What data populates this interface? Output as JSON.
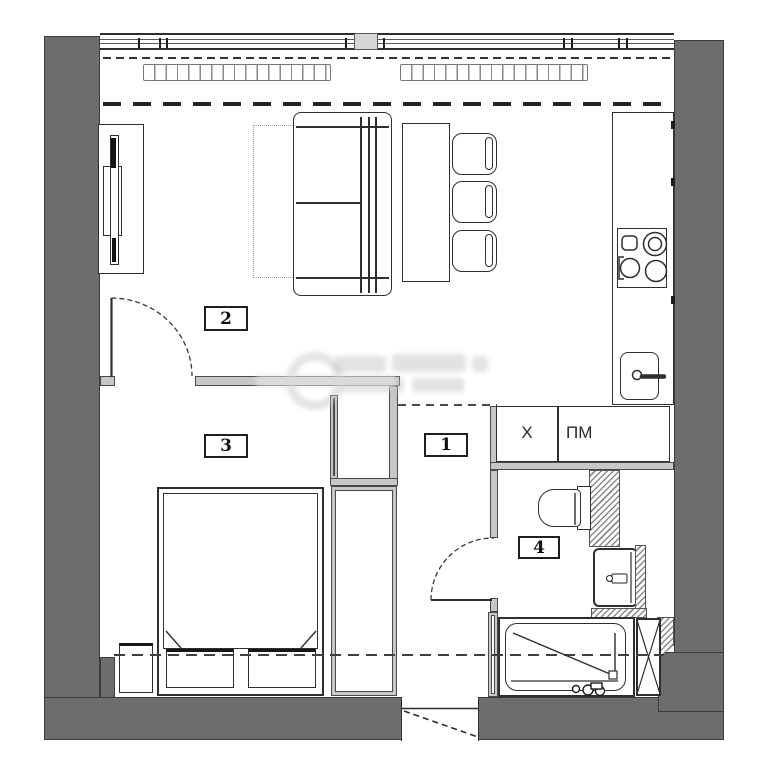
{
  "plan": {
    "type": "apartment-floor-plan",
    "rooms": [
      {
        "key": "living-room",
        "label": "2"
      },
      {
        "key": "bedroom",
        "label": "3"
      },
      {
        "key": "hallway",
        "label": "1"
      },
      {
        "key": "bathroom",
        "label": "4"
      }
    ],
    "appliances": [
      {
        "key": "fridge",
        "label": "Х"
      },
      {
        "key": "dishwasher",
        "label": "ПМ"
      }
    ],
    "colors": {
      "wall": "#6d6d6d",
      "partition": "#c7c7c7",
      "line": "#2e2e2e",
      "hatch": "#8a8a8a"
    },
    "watermark": "blurred illegible gray logo"
  }
}
